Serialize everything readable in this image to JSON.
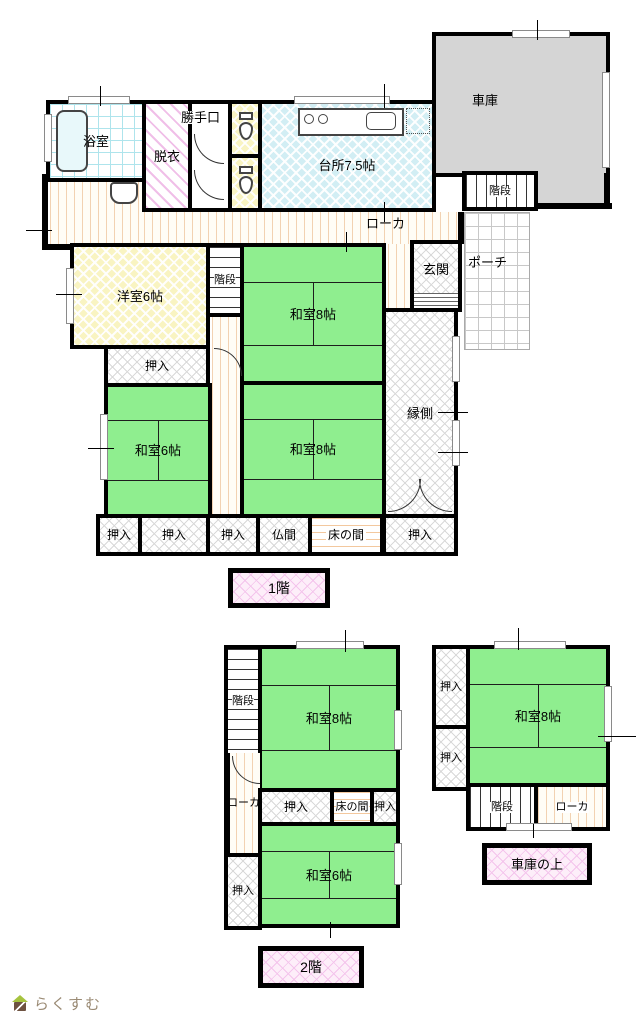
{
  "floor1": {
    "label": "1階",
    "rooms": {
      "bathroom": "浴室",
      "dressing": "脱衣",
      "back_door": "勝手口",
      "kitchen": "台所7.5帖",
      "garage": "車庫",
      "stairs": "階段",
      "hallway": "ローカ",
      "western_room": "洋室6帖",
      "japanese_room_8": "和室8帖",
      "japanese_room_6": "和室6帖",
      "entrance": "玄関",
      "porch": "ポーチ",
      "veranda": "縁側",
      "closet": "押入",
      "buddhist_room": "仏間",
      "alcove": "床の間"
    }
  },
  "floor2": {
    "label": "2階",
    "above_garage_label": "車庫の上",
    "rooms": {
      "stairs": "階段",
      "hallway": "ローカ",
      "japanese_room_8": "和室8帖",
      "japanese_room_6": "和室6帖",
      "closet": "押入",
      "alcove": "床の間"
    }
  },
  "branding": {
    "logo_text": "らくすむ"
  }
}
